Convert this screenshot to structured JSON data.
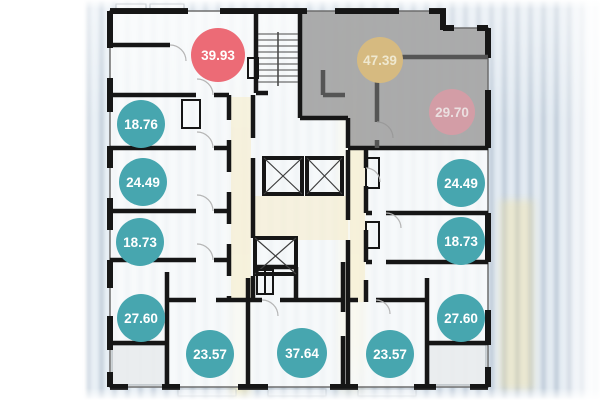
{
  "plan": {
    "kind": "residential-floor-plan",
    "units": [
      {
        "area": "39.93",
        "badge_color": "#ec6b76",
        "text_color": "#ffffff"
      },
      {
        "area": "47.39",
        "badge_color": "#d6ba80",
        "text_color": "#efe8cf"
      },
      {
        "area": "29.70",
        "badge_color": "#d39da6",
        "text_color": "#ebdfe0"
      },
      {
        "area": "18.76",
        "badge_color": "#47a6af",
        "text_color": "#ffffff"
      },
      {
        "area": "24.49",
        "badge_color": "#47a6af",
        "text_color": "#ffffff"
      },
      {
        "area": "24.49",
        "badge_color": "#47a6af",
        "text_color": "#ffffff"
      },
      {
        "area": "18.73",
        "badge_color": "#47a6af",
        "text_color": "#ffffff"
      },
      {
        "area": "18.73",
        "badge_color": "#47a6af",
        "text_color": "#ffffff"
      },
      {
        "area": "27.60",
        "badge_color": "#47a6af",
        "text_color": "#ffffff"
      },
      {
        "area": "27.60",
        "badge_color": "#47a6af",
        "text_color": "#ffffff"
      },
      {
        "area": "23.57",
        "badge_color": "#47a6af",
        "text_color": "#ffffff"
      },
      {
        "area": "37.64",
        "badge_color": "#47a6af",
        "text_color": "#ffffff"
      },
      {
        "area": "23.57",
        "badge_color": "#47a6af",
        "text_color": "#ffffff"
      }
    ]
  },
  "palette": {
    "wall": "#161616",
    "wall_muted": "#555555",
    "sold_overlay": "#9f9f9f",
    "available_badge": "#47a6af",
    "highlight_badge": "#ec6b76",
    "corridor_tint": "#f6ecc9",
    "plan_fill": "#fbfcfd"
  }
}
